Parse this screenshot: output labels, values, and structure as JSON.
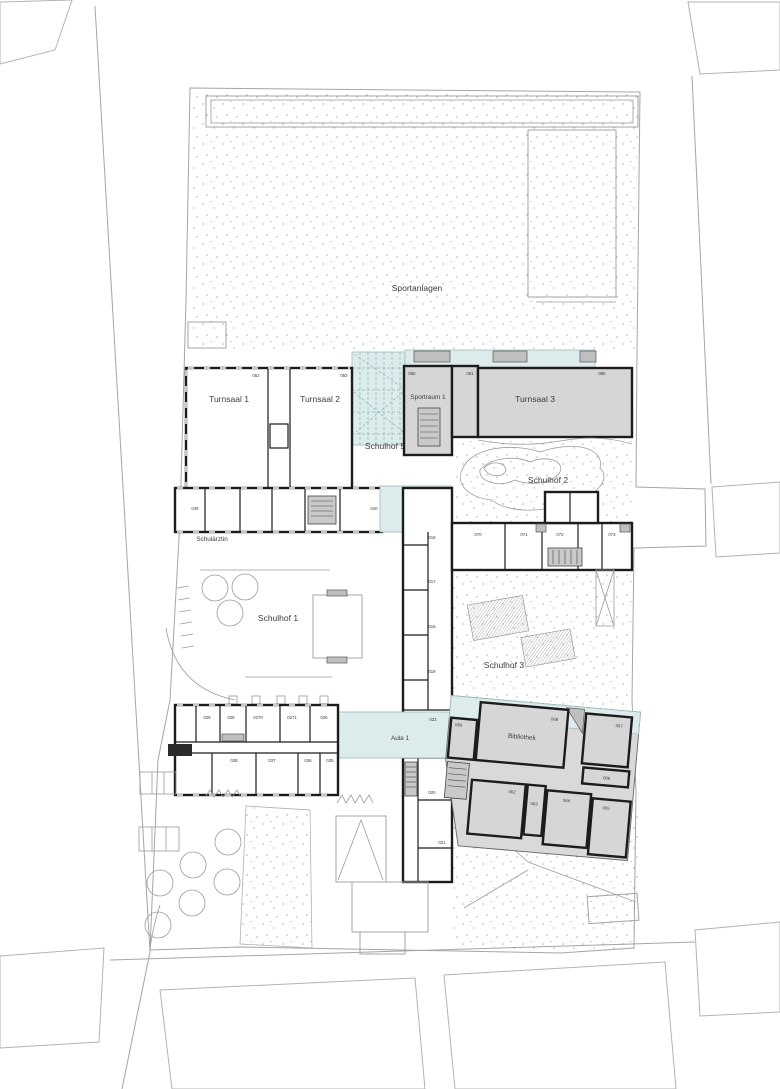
{
  "plan": {
    "area_labels": {
      "sportanlagen": "Sportanlagen",
      "turnsaal1": "Turnsaal 1",
      "turnsaal2": "Turnsaal 2",
      "turnsaal3": "Turnsaal 3",
      "sportraum1": "Sportraum 1",
      "schulhof1": "Schulhof 1",
      "schulhof2": "Schulhof 2",
      "schulhof3": "Schulhof 3",
      "schulhof4": "Schulhof 4",
      "schulhof5": "Schulhof 5",
      "schulaerztin": "Schulärztin",
      "aula1": "Aula 1",
      "bibliothek": "Bibliothek"
    },
    "room_numbers": {
      "052": "052",
      "053": "053",
      "082": "082",
      "081": "081",
      "080": "080",
      "049": "049",
      "040": "040",
      "018": "018",
      "017": "017",
      "016": "016",
      "019": "019",
      "070": "070",
      "071": "071",
      "072": "072",
      "073": "073",
      "022": "022",
      "020": "020",
      "021": "021",
      "069": "069",
      "068": "068",
      "067": "067",
      "066": "066",
      "062": "062",
      "063": "063",
      "064": "064",
      "065": "065",
      "029": "029",
      "028": "028",
      "0270": "0270",
      "0271": "0271",
      "026": "026",
      "038": "038",
      "037": "037",
      "036": "036",
      "035": "035"
    },
    "colors": {
      "hall_fill": "#d6d6d6",
      "atrium_fill": "#dcebeb",
      "wall": "#1c1c1c",
      "site_line": "#a5a5a5",
      "stipple_dot": "#8f8f8f"
    }
  }
}
